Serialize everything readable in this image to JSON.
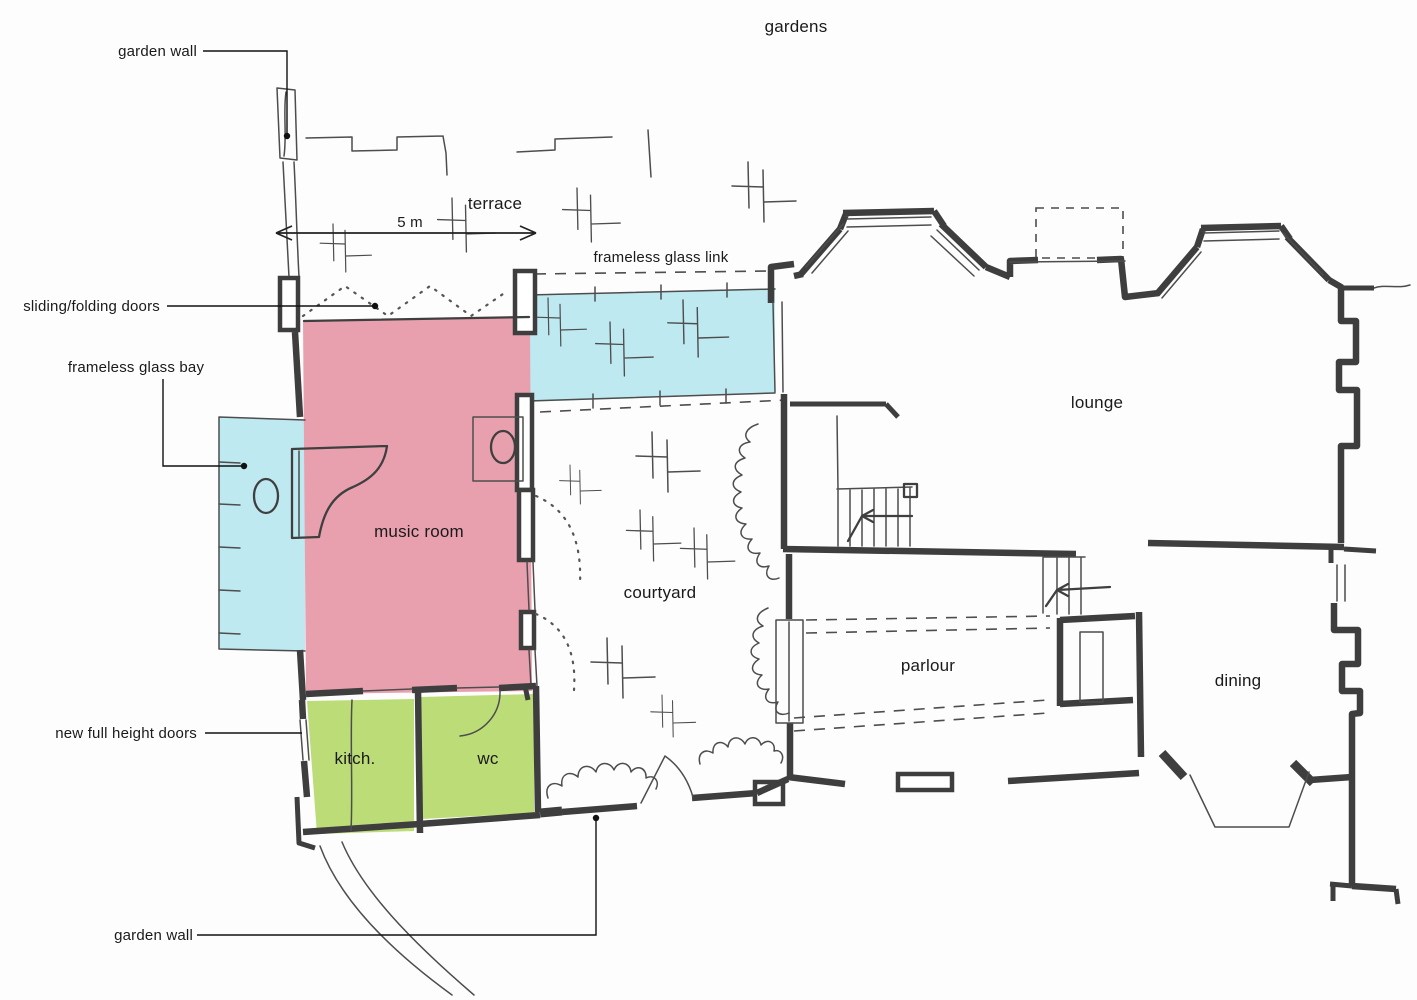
{
  "colors": {
    "background": "#fdfdfd",
    "wall": "#3e3e3e",
    "sketch_line": "#4d4d4d",
    "glass_fill": "#bfe9f1",
    "music_room_fill": "#e9a0ae",
    "service_fill": "#bcdc77"
  },
  "labels": {
    "gardens": "gardens",
    "terrace": "terrace",
    "scale": "5 m",
    "garden_wall_top": "garden wall",
    "garden_wall_bottom": "garden wall",
    "sliding_folding_doors": "sliding/folding doors",
    "frameless_glass_bay": "frameless glass bay",
    "frameless_glass_link": "frameless glass link",
    "new_full_height_doors": "new full height doors"
  },
  "rooms": {
    "music_room": "music room",
    "courtyard": "courtyard",
    "lounge": "lounge",
    "parlour": "parlour",
    "dining": "dining",
    "kitchen": "kitch.",
    "wc": "wc"
  }
}
